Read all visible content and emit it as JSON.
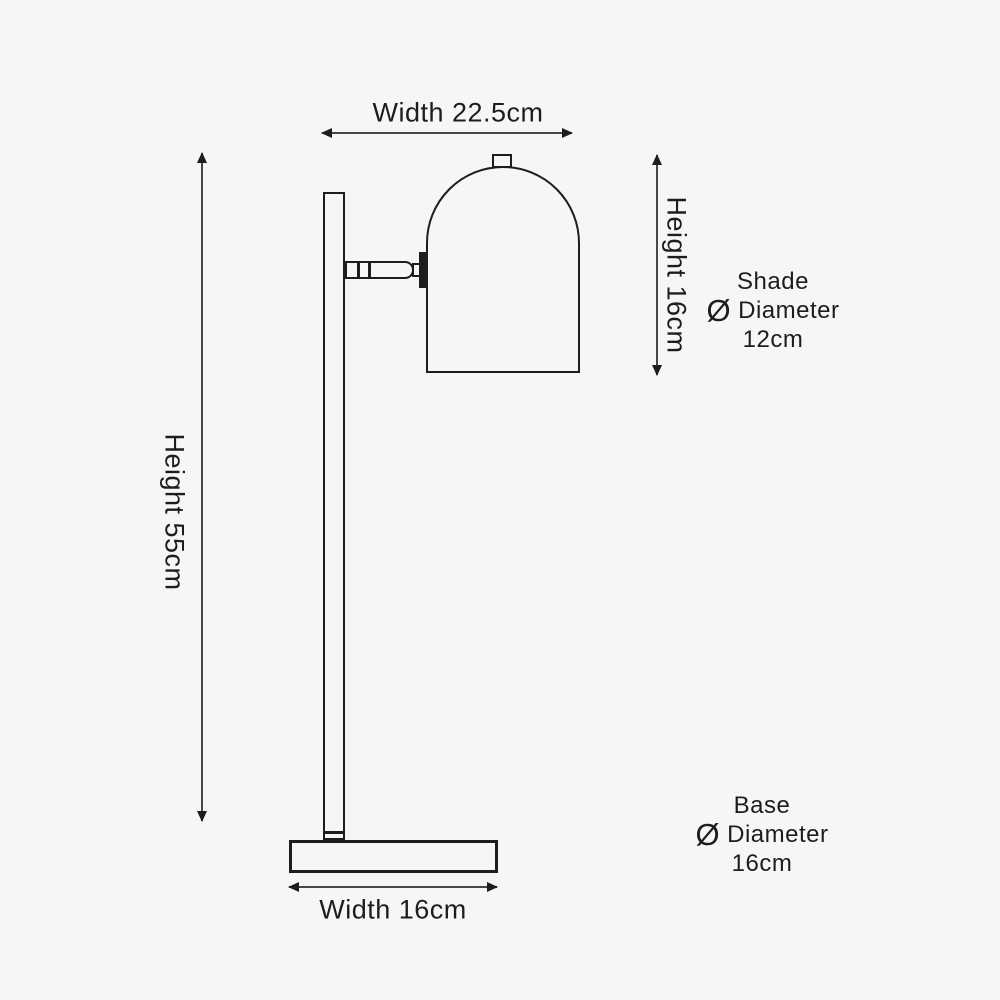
{
  "canvas": {
    "background_color": "#f6f6f6",
    "line_color": "#1d1d1d",
    "arrow_color": "#474747"
  },
  "labels": {
    "top_width": "Width 22.5cm",
    "overall_height": "Height 55cm",
    "shade_height": "Height 16cm",
    "base_width": "Width 16cm"
  },
  "shade_note": {
    "line1": "Shade",
    "symbol": "Ø",
    "line2": "Diameter",
    "line3": "12cm"
  },
  "base_note": {
    "line1": "Base",
    "symbol": "Ø",
    "line2": "Diameter",
    "line3": "16cm"
  },
  "dimensions": {
    "overall_width_cm": 22.5,
    "overall_height_cm": 55,
    "shade_height_cm": 16,
    "shade_diameter_cm": 12,
    "base_width_cm": 16,
    "base_diameter_cm": 16
  }
}
